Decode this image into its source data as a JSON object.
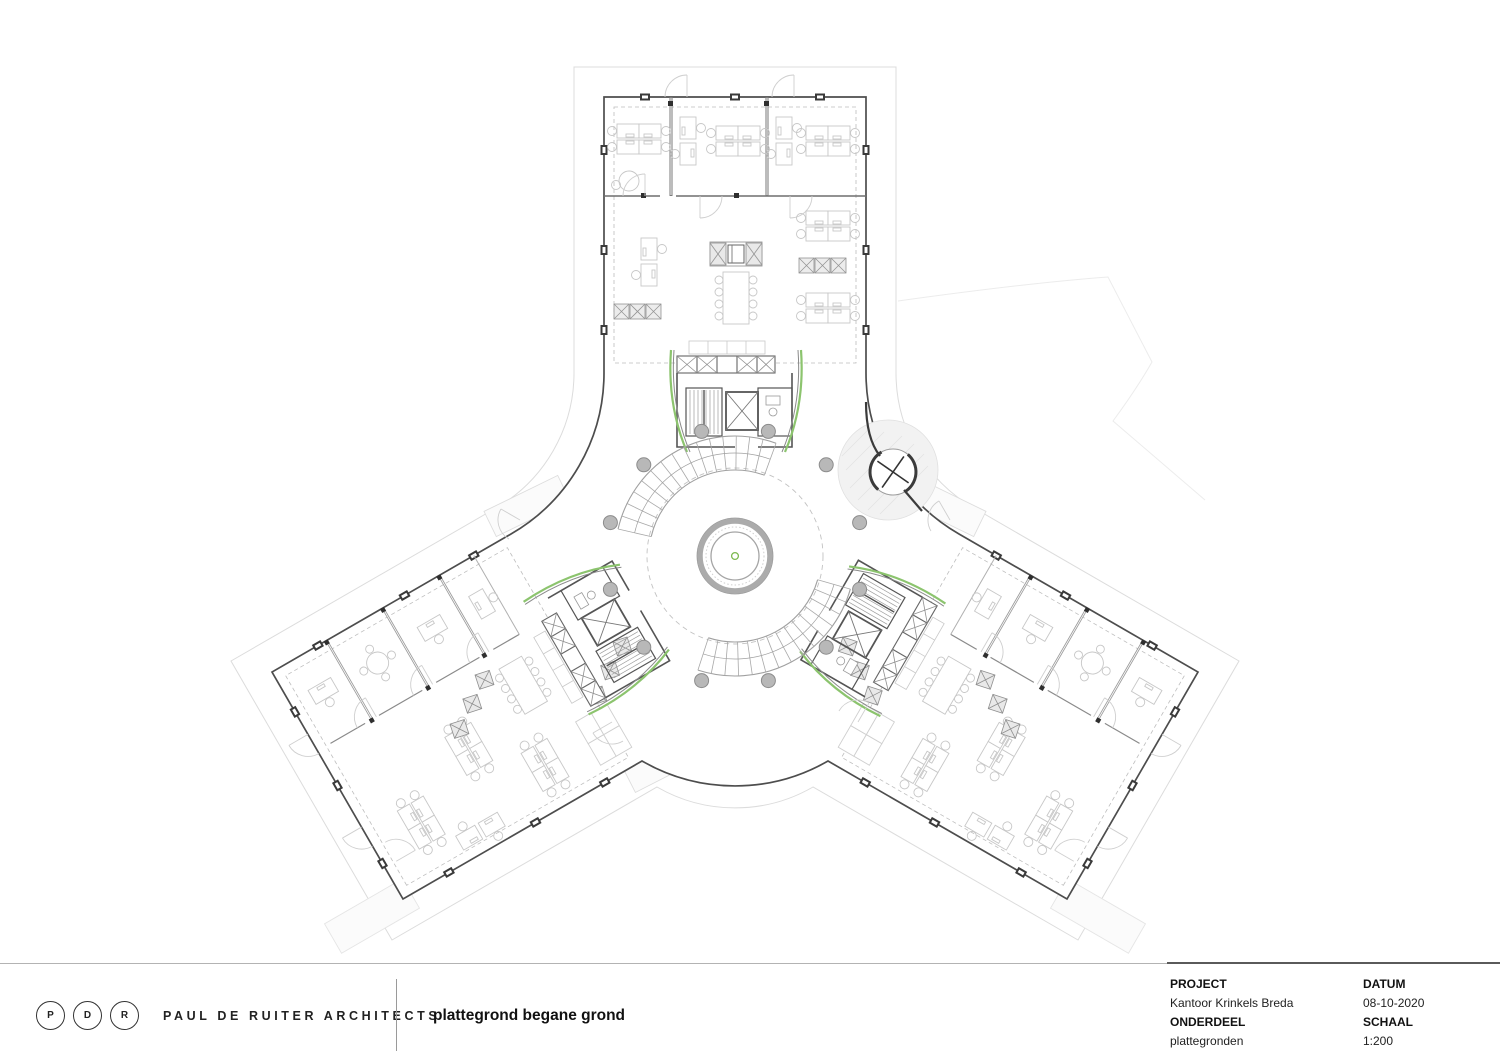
{
  "drawing": {
    "type": "architectural floor plan, Y-shaped office building with circular central atrium",
    "colors": {
      "wall": "#4d4d4d",
      "partition": "#7a7a7a",
      "site_line": "#dcdcdc",
      "furniture_line": "#c7c7c7",
      "accent_green": "#8cc46e",
      "column_fill": "#b8b8b8",
      "stair_line": "#a0a0a0"
    }
  },
  "footer": {
    "logo_letters": [
      "P",
      "D",
      "R"
    ],
    "brand": "PAUL DE RUITER ARCHITECTS",
    "drawing_title": "plattegrond begane grond",
    "title_block": {
      "project_label": "PROJECT",
      "project_value": "Kantoor Krinkels Breda",
      "onderdeel_label": "ONDERDEEL",
      "onderdeel_value": "plattegronden",
      "datum_label": "DATUM",
      "datum_value": "08-10-2020",
      "schaal_label": "SCHAAL",
      "schaal_value": "1:200"
    }
  }
}
